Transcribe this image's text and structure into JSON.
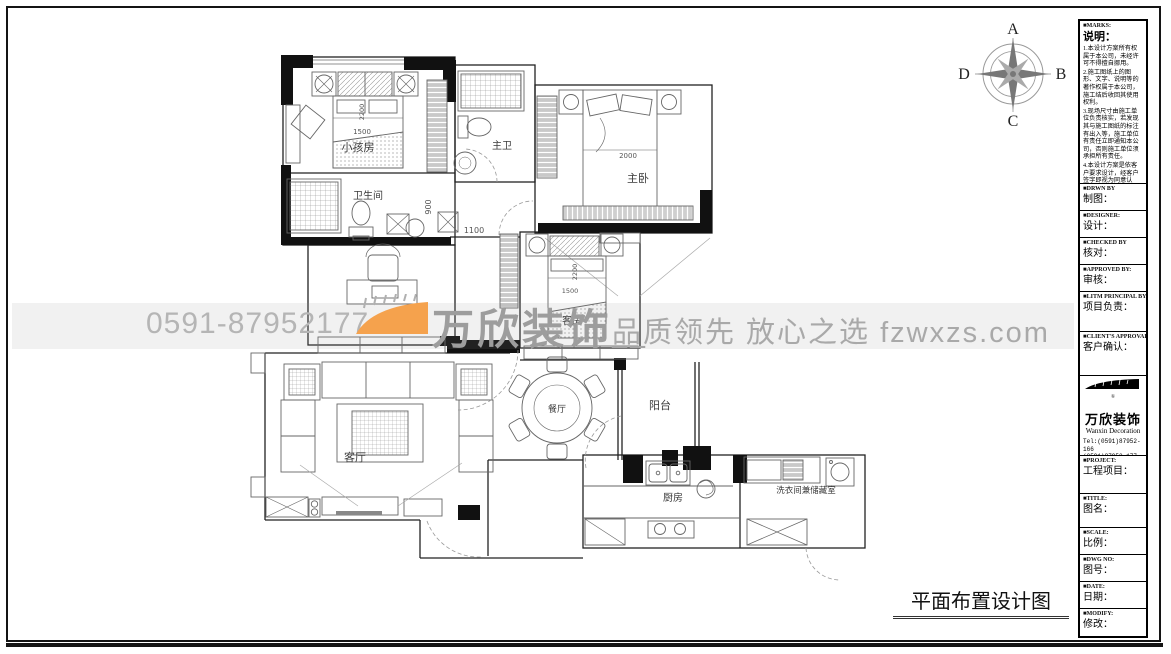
{
  "sheet": {
    "drawing_title": "平面布置设计图",
    "compass": {
      "north": "A",
      "east": "B",
      "south": "C",
      "west": "D"
    }
  },
  "watermark": {
    "phone": "0591-87952177",
    "brand": "万欣装饰",
    "brand_suffix": "__",
    "slogan": "品质领先 放心之选 fzwxzs.com",
    "accent_color": "#F5A24D"
  },
  "plan": {
    "rooms": {
      "kids_bedroom": "小孩房",
      "bathroom": "卫生间",
      "master_bathroom": "主卫",
      "master_bedroom": "主卧",
      "study": "书房",
      "guest_bedroom": "客房",
      "living_room": "客厅",
      "dining_room": "餐厅",
      "balcony": "阳台",
      "kitchen": "厨房",
      "laundry_storage": "洗衣间兼储藏室"
    },
    "dimensions": {
      "kids_bed_width": "1500",
      "kids_bed_length": "2200",
      "corridor_width": "900",
      "hall_width": "1100",
      "master_bed_width": "2000",
      "guest_bed_length": "2200",
      "guest_bed_width": "1500"
    }
  },
  "titleblock": {
    "marks": {
      "en": "■MARKS:",
      "zh": "说明：",
      "notes": [
        "1.本设计方案所有权属于本公司，未经许可不得擅自挪用。",
        "2.施工图纸上的图形、文字、说明等的著作权属于本公司，施工结后收回其使用权利。",
        "3.现场尺寸由施工单位负责核实，若发现其与施工图纸的标注有出入等，施工单位有责任立即通知本公司，否则施工单位须承担所有责任。",
        "4.本设计方案是依客户要求设计，经客户签字即视为同意认可，不得随意更改。"
      ]
    },
    "fields": [
      {
        "en": "■DRWN BY",
        "zh": "制图："
      },
      {
        "en": "■DESIGNER:",
        "zh": "设计："
      },
      {
        "en": "■CHECKED BY",
        "zh": "核对："
      },
      {
        "en": "■APPROVED BY:",
        "zh": "审核："
      },
      {
        "en": "■LITM PRINCIPAL BY:",
        "zh": "项目负责："
      },
      {
        "en": "■CLIENT'S APPROVAL:",
        "zh": "客户确认："
      }
    ],
    "company": {
      "reg": "®",
      "name": "万欣装饰",
      "name_en": "Wanxin Decoration",
      "tel1": "Tel:(0591)87952-166",
      "tel2": "    (0591)87952-177",
      "fax": "Fax:(0591)87952-199",
      "web": "Web:WWW.fzwxzs.com"
    },
    "fields2": [
      {
        "en": "■PROJECT:",
        "zh": "工程项目："
      },
      {
        "en": "■TITLE:",
        "zh": "图名："
      },
      {
        "en": "■SCALE:",
        "zh": "比例："
      },
      {
        "en": "■DWG NO:",
        "zh": "图号："
      },
      {
        "en": "■DATE:",
        "zh": "日期："
      },
      {
        "en": "■MODIFY:",
        "zh": "修改："
      }
    ]
  }
}
